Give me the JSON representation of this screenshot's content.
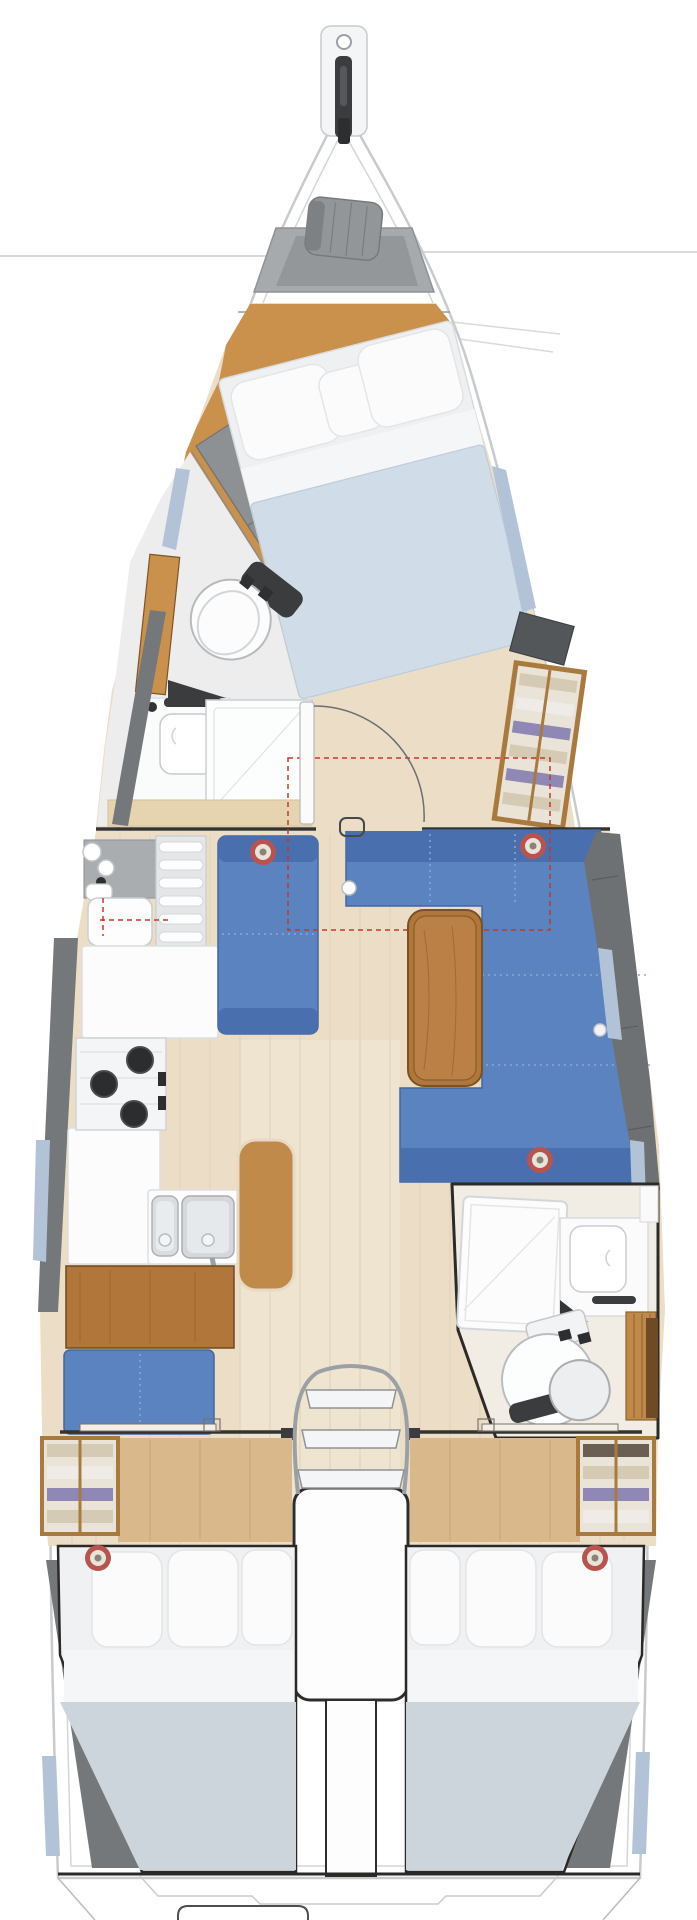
{
  "meta": {
    "title": "sailboat-interior-floor-plan",
    "view": "top-down",
    "hull_length_px": 1816,
    "beam_px": 624
  },
  "palette": {
    "hull_stroke": "#c7cbce",
    "deck_line": "#d3d6d9",
    "rig_line": "#d8dadb",
    "locker_gray": "#a7aaac",
    "locker_gray_dark": "#94979a",
    "sailbag": "#939698",
    "sailbag_dark": "#7e8183",
    "wood_orange": "#c9914c",
    "wood_orange_line": "#b5823f",
    "wood_pale": "#ecdec6",
    "wood_pale_line": "#dfd0b6",
    "wood_door_area": "#d9b98c",
    "bed_base": "#eef0f2",
    "pillow_white": "#fbfbfc",
    "sheet_white": "#f5f6f7",
    "duvet_blue": "#d0dde9",
    "duvet_aft": "#ccd5dc",
    "gray_shelf": "#8e9194",
    "gray_band": "#75787b",
    "gray_back": "#6e7174",
    "settee_blue": "#5b83bf",
    "settee_dark": "#4a6fae",
    "settee_seam": "#8aa8d5",
    "table_wood": "#b0763a",
    "table_wood_light": "#ba8046",
    "counter_white": "#fcfcfd",
    "counter_stroke": "#d8dbdd",
    "appliance_gray": "#dadde0",
    "burner_dark": "#2b2d2f",
    "fixture_dark": "#3a3c3e",
    "chrome": "#9aa0a4",
    "bulkhead_dark": "#35332f",
    "outline_dark": "#2d2b29",
    "speaker_red": "#b85450",
    "speaker_cream": "#e9e4da",
    "window_blue": "#b3c3d7",
    "wardrobe_frame": "#a97a3e",
    "wardrobe_bg": "#e9e3d8",
    "clothes_beige": "#d5cab4",
    "clothes_white": "#efece8",
    "clothes_purple": "#8f88b5",
    "clothes_brown": "#6a5f52",
    "leather_tan": "#c08b4a",
    "leather_rim": "#e8d9c4",
    "dashed_red": "#c0392b",
    "door_arc": "#6b6e71",
    "head_floor": "#f2ede4",
    "fwd_head_floor": "#ededee",
    "vanity_wood": "#e6d3b0",
    "slat_wood": "#c08948",
    "cab_brown": "#6e4a26"
  },
  "boat": {
    "bow": {
      "features": [
        "bowsprit",
        "furling-drum",
        "anchor-roller",
        "anchor-locker",
        "sail-bag"
      ]
    },
    "forward_cabin": {
      "name": "owner-cabin",
      "berth": {
        "type": "double",
        "orientation": "diagonal",
        "pillows": 3
      },
      "headboard_shelf_cells": 2,
      "hanging_locker_shelf_rows": 6
    },
    "forward_head": {
      "features": [
        "toilet",
        "washbasin",
        "faucet",
        "shower-stall",
        "wood-door"
      ]
    },
    "salon": {
      "port_settee_cushions": 2,
      "starboard_settee_cushions": 4,
      "table": "fore-aft wooden table",
      "table_extension": "red dashed outline",
      "speakers": 3,
      "table_leg_socket": 1
    },
    "galley": {
      "burners": 3,
      "sinks": 2,
      "features": [
        "dish-rack",
        "top-load-fridge",
        "worktop",
        "stove",
        "double-sink",
        "faucet",
        "bottle-rack"
      ]
    },
    "nav_station": {
      "features": [
        "chart-table",
        "tan-leather-bench",
        "blue-bench"
      ]
    },
    "aft_head": {
      "features": [
        "shower-stall",
        "washbasin",
        "faucet",
        "toilet",
        "wood-locker"
      ]
    },
    "companionway": {
      "steps": 3,
      "features": [
        "chrome-handrails",
        "engine-box",
        "port-cabin-door",
        "starboard-cabin-door"
      ]
    },
    "aft_cabin_port": {
      "berth": {
        "type": "double",
        "pillows": 3
      },
      "wardrobe_rows": 4,
      "speakers": 1
    },
    "aft_cabin_starboard": {
      "berth": {
        "type": "double",
        "pillows": 3
      },
      "wardrobe_rows": 4,
      "speakers": 1
    },
    "transom": {
      "features": [
        "swim-platform",
        "locker-hatch"
      ]
    },
    "hull_windows": 7,
    "total_speakers": 5
  }
}
